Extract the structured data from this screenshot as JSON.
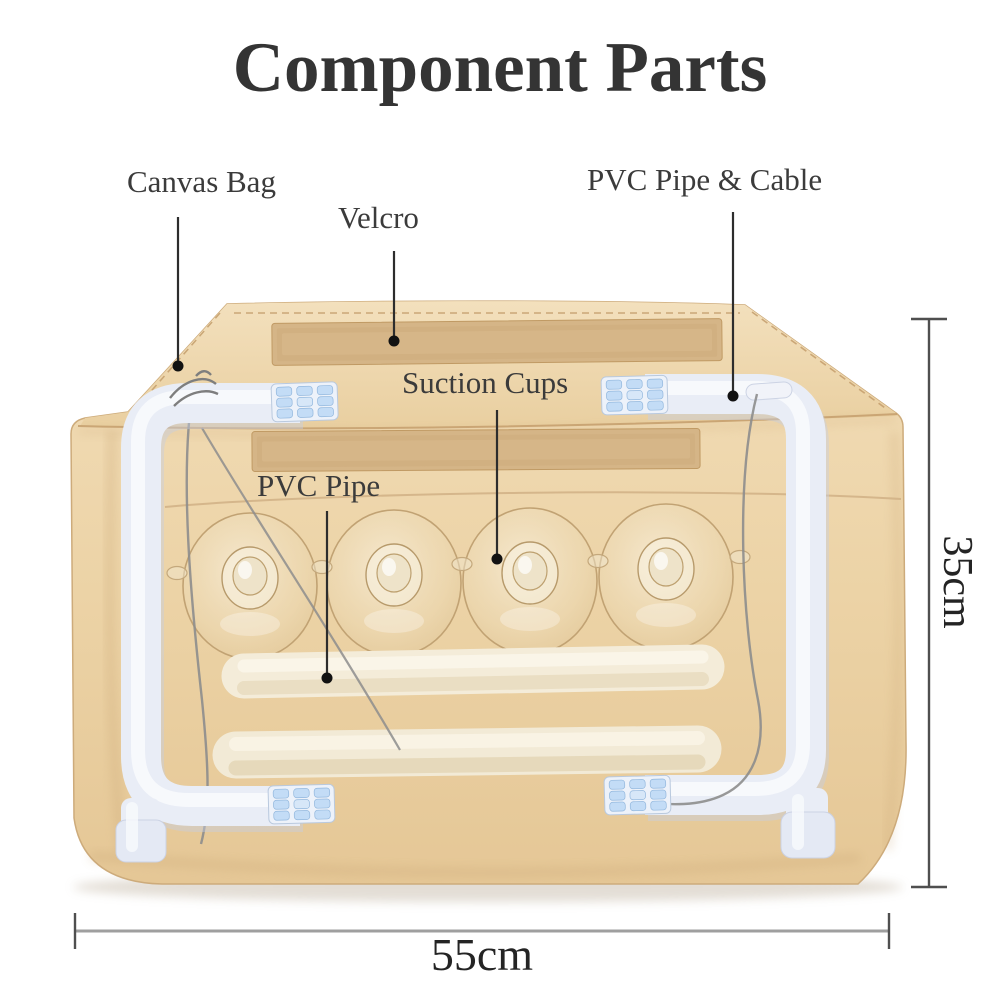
{
  "title": "Component Parts",
  "callouts": [
    {
      "id": "canvas-bag",
      "label": "Canvas Bag"
    },
    {
      "id": "velcro",
      "label": "Velcro"
    },
    {
      "id": "pvc-pipe-cable",
      "label": "PVC Pipe & Cable"
    },
    {
      "id": "suction-cups",
      "label": "Suction Cups"
    },
    {
      "id": "pvc-pipe",
      "label": "PVC Pipe"
    }
  ],
  "dimensions": {
    "height_label": "35cm",
    "width_label": "55cm"
  },
  "components": {
    "bag": "canvas storage bag",
    "velcro_strip_count": 2,
    "suction_cup_count": 4,
    "loose_pipe_count": 2,
    "frame_corner_count": 4
  },
  "colors": {
    "canvas_tan": "#ecd3a6",
    "velcro_tan": "#d5b587",
    "pipe_white": "#e9edf6",
    "holder_blue": "#c3dcf6",
    "loose_pipe_cream": "#f4ecd9",
    "cable_gray": "#8d8d8d",
    "leader_black": "#2d2d2d",
    "dimension_gray": "#9f9f9f",
    "text_dark": "#3b3b3b"
  }
}
